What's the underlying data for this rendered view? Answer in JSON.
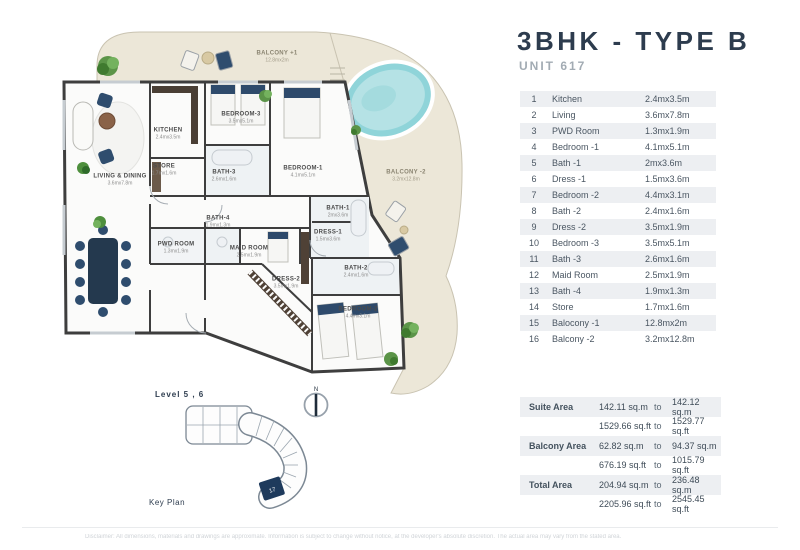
{
  "title": "3BHK - TYPE B",
  "subtitle": "UNIT 617",
  "rooms_table": {
    "rows": [
      {
        "no": "1",
        "name": "Kitchen",
        "size": "2.4mx3.5m"
      },
      {
        "no": "2",
        "name": "Living",
        "size": "3.6mx7.8m"
      },
      {
        "no": "3",
        "name": "PWD Room",
        "size": "1.3mx1.9m"
      },
      {
        "no": "4",
        "name": "Bedroom -1",
        "size": "4.1mx5.1m"
      },
      {
        "no": "5",
        "name": "Bath -1",
        "size": "2mx3.6m"
      },
      {
        "no": "6",
        "name": "Dress -1",
        "size": "1.5mx3.6m"
      },
      {
        "no": "7",
        "name": "Bedroom -2",
        "size": "4.4mx3.1m"
      },
      {
        "no": "8",
        "name": "Bath -2",
        "size": "2.4mx1.6m"
      },
      {
        "no": "9",
        "name": "Dress -2",
        "size": "3.5mx1.9m"
      },
      {
        "no": "10",
        "name": "Bedroom -3",
        "size": "3.5mx5.1m"
      },
      {
        "no": "11",
        "name": "Bath -3",
        "size": "2.6mx1.6m"
      },
      {
        "no": "12",
        "name": "Maid Room",
        "size": "2.5mx1.9m"
      },
      {
        "no": "13",
        "name": "Bath -4",
        "size": "1.9mx1.3m"
      },
      {
        "no": "14",
        "name": "Store",
        "size": "1.7mx1.6m"
      },
      {
        "no": "15",
        "name": "Balocony -1",
        "size": "12.8mx2m"
      },
      {
        "no": "16",
        "name": "Balcony -2",
        "size": "3.2mx12.8m"
      }
    ]
  },
  "area_table": {
    "range_word": "to",
    "rows": [
      {
        "label": "Suite Area",
        "from": "142.11 sq.m",
        "to": "142.12 sq.m"
      },
      {
        "label": "",
        "from": "1529.66 sq.ft",
        "to": "1529.77 sq.ft"
      },
      {
        "label": "Balcony Area",
        "from": "62.82 sq.m",
        "to": "94.37 sq.m"
      },
      {
        "label": "",
        "from": "676.19 sq.ft",
        "to": "1015.79 sq.ft"
      },
      {
        "label": "Total Area",
        "from": "204.94 sq.m",
        "to": "236.48 sq.m"
      },
      {
        "label": "",
        "from": "2205.96 sq.ft",
        "to": "2545.45 sq.ft"
      }
    ]
  },
  "floor_plan": {
    "plan_labels": [
      {
        "name": "BALCONY +1",
        "dim": "12.8mx2m"
      },
      {
        "name": "BALCONY -2",
        "dim": "3.2mx12.8m"
      },
      {
        "name": "KITCHEN",
        "dim": "2.4mx3.5m"
      },
      {
        "name": "STORE",
        "dim": "1.7mx1.6m"
      },
      {
        "name": "BATH-3",
        "dim": "2.6mx1.6m"
      },
      {
        "name": "LIVING & DINING",
        "dim": "3.6mx7.8m"
      },
      {
        "name": "PWD ROOM",
        "dim": "1.3mx1.9m"
      },
      {
        "name": "BATH-4",
        "dim": "1.9mx1.3m"
      },
      {
        "name": "MAID ROOM",
        "dim": "2.5mx1.9m"
      },
      {
        "name": "BEDROOM-3",
        "dim": "3.5mx5.1m"
      },
      {
        "name": "BEDROOM-1",
        "dim": "4.1mx5.1m"
      },
      {
        "name": "BATH-1",
        "dim": "2mx3.6m"
      },
      {
        "name": "DRESS-1",
        "dim": "1.5mx3.6m"
      },
      {
        "name": "DRESS-2",
        "dim": "3.5mx1.9m"
      },
      {
        "name": "BATH-2",
        "dim": "2.4mx1.6m"
      },
      {
        "name": "BEDROOM-2",
        "dim": "4.4mx3.1m"
      }
    ]
  },
  "key_plan": {
    "level_label": "Level 5 , 6",
    "caption": "Key Plan",
    "highlighted_unit": "17"
  },
  "compass": {
    "label": "N"
  },
  "footer": {
    "disclaimer": "Disclaimer: All dimensions, materials and drawings are approximate. Information is subject to change without notice, at the developer's absolute discretion. The actual area may vary from the stated area."
  },
  "colors": {
    "accent_navy": "#2d3c4e",
    "row_shade": "#edeff2",
    "balcony_cream": "#ece7d8",
    "pool_water": "#b5e2e5",
    "wall": "#3e3e3e",
    "highlight_unit": "#1e3a5c"
  }
}
